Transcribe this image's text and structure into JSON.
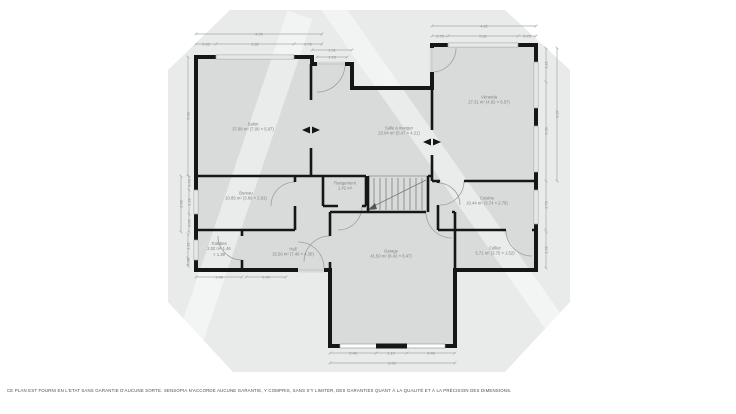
{
  "colors": {
    "wall": "#161616",
    "floor": "#d9dbdb",
    "backdrop": "#e9ebeb",
    "dimension_line": "#a5a8a8",
    "label_text": "#7f8484"
  },
  "rooms": [
    {
      "id": "salon",
      "name": "Salon",
      "area": "37.88 m²",
      "size": "(7.00 × 5.87)"
    },
    {
      "id": "salle-a-manger",
      "name": "Salle à manger",
      "area": "23.04 m²",
      "size": "(5.47 × 4.21)"
    },
    {
      "id": "veranda",
      "name": "Véranda",
      "area": "27.31 m²",
      "size": "(4.82 × 6.57)"
    },
    {
      "id": "bureau",
      "name": "Bureau",
      "area": "10.85 m²",
      "size": "(3.89 × 2.91)"
    },
    {
      "id": "rangement",
      "name": "Rangement",
      "area": "1.42 m²",
      "size": ""
    },
    {
      "id": "cuisine",
      "name": "Cuisine",
      "area": "10.44 m²",
      "size": "(3.74 × 2.79)"
    },
    {
      "id": "toilettes",
      "name": "Toilettes",
      "area": "2.02 m²",
      "size": "1.46 × 1.39"
    },
    {
      "id": "hall",
      "name": "Hall",
      "area": "15.50 m²",
      "size": "(7.48 × 4.30)"
    },
    {
      "id": "garage",
      "name": "Garage",
      "area": "41.50 m²",
      "size": "(6.42 × 6.47)"
    },
    {
      "id": "cellier",
      "name": "Cellier",
      "area": "5.71 m²",
      "size": "(3.75 × 1.52)"
    }
  ],
  "dims": {
    "salon_top_total": "4.95",
    "salon_top_a": "0.95",
    "salon_top_b": "2.82",
    "salon_top_c": "0.76",
    "entry_a": "1.91",
    "entry_b": "1.03",
    "veranda_top_total": "4.82",
    "veranda_top_a": "0.75",
    "veranda_top_b": "2.81",
    "veranda_top_c": "0.75",
    "right_a": "1.21",
    "right_b": "5.36",
    "right_total": "6.57",
    "cuisine_right": "2.79",
    "cellier_right": "1.52",
    "salon_left": "5.88",
    "left_total": "2.96",
    "left_a": "0.73",
    "left_b": "1.22",
    "left_c": "0.95",
    "toilettes_left_a": "1.21",
    "toilettes_left_b": "0.36",
    "toilettes_bottom": "1.46",
    "hall_bottom": "2.40",
    "garage_a": "2.46",
    "garage_b": "1.19",
    "garage_c": "2.46",
    "garage_total": "6.42"
  },
  "footer": {
    "disclaimer": "CE PLAN EST FOURNI EN L'ETAT SANS GARANTIE D'AUCUNE SORTE. SENSOPIA N'ACCORDE AUCUNE GARANTIE, Y COMPRIS, SANS S'Y LIMITER, DES GARANTIES QUANT À LA QUALITÉ ET À LA PRÉCISION DES DIMENSIONS."
  }
}
